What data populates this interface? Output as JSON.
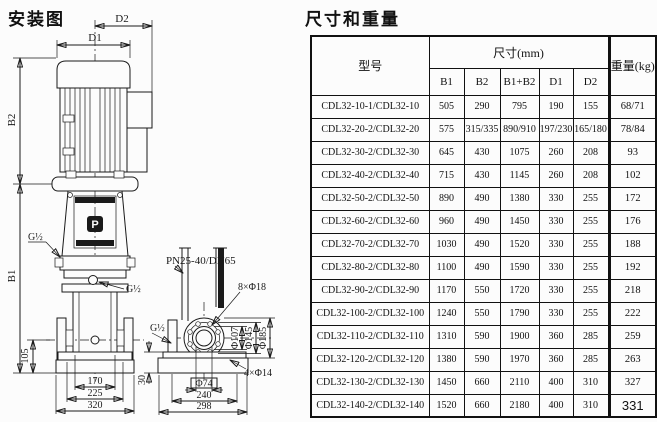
{
  "page": {
    "diagram_title": "安装图",
    "table_title": "尺寸和重量"
  },
  "diagram": {
    "labels": {
      "d1": "D1",
      "d2": "D2",
      "b1": "B1",
      "b2": "B2",
      "g_half": "G½",
      "dim_105": "105",
      "dim_170": "170",
      "dim_225": "225",
      "dim_320": "320",
      "dim_30": "30",
      "flange_spec": "PN25-40/DN65",
      "bolt_circle": "8×Φ18",
      "dia_107": "Φ107",
      "dia_145": "Φ145",
      "dia_185": "Φ185",
      "dia_74": "Φ74",
      "base_holes": "4×Φ14",
      "logo": "P"
    }
  },
  "table": {
    "header": {
      "model": "型号",
      "size_group": "尺寸(mm)",
      "size_cols": [
        "B1",
        "B2",
        "B1+B2",
        "D1",
        "D2"
      ],
      "weight": "重量(kg)"
    },
    "rows": [
      {
        "model": "CDL32-10-1/CDL32-10",
        "b1": "505",
        "b2": "290",
        "b1b2": "795",
        "d1": "190",
        "d2": "155",
        "weight": "68/71"
      },
      {
        "model": "CDL32-20-2/CDL32-20",
        "b1": "575",
        "b2": "315/335",
        "b1b2": "890/910",
        "d1": "197/230",
        "d2": "165/180",
        "weight": "78/84"
      },
      {
        "model": "CDL32-30-2/CDL32-30",
        "b1": "645",
        "b2": "430",
        "b1b2": "1075",
        "d1": "260",
        "d2": "208",
        "weight": "93"
      },
      {
        "model": "CDL32-40-2/CDL32-40",
        "b1": "715",
        "b2": "430",
        "b1b2": "1145",
        "d1": "260",
        "d2": "208",
        "weight": "102"
      },
      {
        "model": "CDL32-50-2/CDL32-50",
        "b1": "890",
        "b2": "490",
        "b1b2": "1380",
        "d1": "330",
        "d2": "255",
        "weight": "172"
      },
      {
        "model": "CDL32-60-2/CDL32-60",
        "b1": "960",
        "b2": "490",
        "b1b2": "1450",
        "d1": "330",
        "d2": "255",
        "weight": "176"
      },
      {
        "model": "CDL32-70-2/CDL32-70",
        "b1": "1030",
        "b2": "490",
        "b1b2": "1520",
        "d1": "330",
        "d2": "255",
        "weight": "188"
      },
      {
        "model": "CDL32-80-2/CDL32-80",
        "b1": "1100",
        "b2": "490",
        "b1b2": "1590",
        "d1": "330",
        "d2": "255",
        "weight": "192"
      },
      {
        "model": "CDL32-90-2/CDL32-90",
        "b1": "1170",
        "b2": "550",
        "b1b2": "1720",
        "d1": "330",
        "d2": "255",
        "weight": "218"
      },
      {
        "model": "CDL32-100-2/CDL32-100",
        "b1": "1240",
        "b2": "550",
        "b1b2": "1790",
        "d1": "330",
        "d2": "255",
        "weight": "222"
      },
      {
        "model": "CDL32-110-2/CDL32-110",
        "b1": "1310",
        "b2": "590",
        "b1b2": "1900",
        "d1": "360",
        "d2": "285",
        "weight": "259"
      },
      {
        "model": "CDL32-120-2/CDL32-120",
        "b1": "1380",
        "b2": "590",
        "b1b2": "1970",
        "d1": "360",
        "d2": "285",
        "weight": "263"
      },
      {
        "model": "CDL32-130-2/CDL32-130",
        "b1": "1450",
        "b2": "660",
        "b1b2": "2110",
        "d1": "400",
        "d2": "310",
        "weight": "327"
      },
      {
        "model": "CDL32-140-2/CDL32-140",
        "b1": "1520",
        "b2": "660",
        "b1b2": "2180",
        "d1": "400",
        "d2": "310",
        "weight": "331"
      }
    ]
  }
}
